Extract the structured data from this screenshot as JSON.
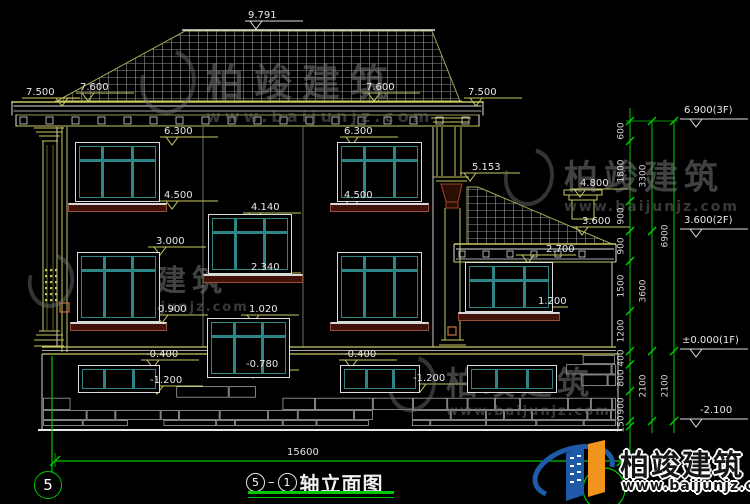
{
  "canvas": {
    "background": "#000000"
  },
  "colors": {
    "line_yellow": "#c8c860",
    "line_white": "#e0e0e0",
    "annotation_green": "#00c800",
    "window_teal": "#2e8585",
    "sill_brown": "#94503a",
    "logo_blue": "#1e5aa8",
    "logo_orange": "#f0941e"
  },
  "watermark": {
    "brand": "柏竣建筑",
    "site": "www.baijunjz.com"
  },
  "footer_logo": {
    "brand": "柏竣建筑",
    "site": "www.baijunjz.com"
  },
  "axis": {
    "left_bubble": "5",
    "bottom_width": "15600"
  },
  "title_block": {
    "axis_from": "5",
    "separator": "–",
    "axis_to": "1",
    "name": "轴立面图"
  },
  "levels": [
    {
      "label": "9.791",
      "tx": 248,
      "ty": 11,
      "x1": 245,
      "x2": 303,
      "y": 21,
      "tax": 256,
      "c": "w"
    },
    {
      "label": "7.600",
      "tx": 80,
      "ty": 83,
      "x1": 76,
      "x2": 134,
      "y": 93,
      "tax": 88,
      "c": "y"
    },
    {
      "label": "7.500",
      "tx": 26,
      "ty": 88,
      "x1": 22,
      "x2": 80,
      "y": 98,
      "tax": 62,
      "c": "y"
    },
    {
      "label": "7.600",
      "tx": 366,
      "ty": 83,
      "x1": 362,
      "x2": 420,
      "y": 93,
      "tax": 374,
      "c": "y"
    },
    {
      "label": "7.500",
      "tx": 468,
      "ty": 88,
      "x1": 464,
      "x2": 522,
      "y": 98,
      "tax": 476,
      "c": "y"
    },
    {
      "label": "6.300",
      "tx": 164,
      "ty": 127,
      "x1": 160,
      "x2": 218,
      "y": 137,
      "tax": 172,
      "c": "y"
    },
    {
      "label": "4.500",
      "tx": 164,
      "ty": 191,
      "x1": 160,
      "x2": 218,
      "y": 201,
      "tax": 172,
      "c": "y"
    },
    {
      "label": "6.300",
      "tx": 344,
      "ty": 127,
      "x1": 340,
      "x2": 398,
      "y": 137,
      "tax": 352,
      "c": "y"
    },
    {
      "label": "4.500",
      "tx": 344,
      "ty": 191,
      "x1": 340,
      "x2": 398,
      "y": 201,
      "tax": 352,
      "c": "y"
    },
    {
      "label": "5.153",
      "tx": 472,
      "ty": 163,
      "x1": 460,
      "x2": 520,
      "y": 173,
      "tax": 470,
      "c": "y"
    },
    {
      "label": "4.800",
      "tx": 580,
      "ty": 179,
      "x1": 570,
      "x2": 628,
      "y": 189,
      "tax": 580,
      "c": "y"
    },
    {
      "label": "3.600",
      "tx": 582,
      "ty": 217,
      "x1": 572,
      "x2": 630,
      "y": 227,
      "tax": 582,
      "c": "y"
    },
    {
      "label": "4.140",
      "tx": 251,
      "ty": 203,
      "x1": 243,
      "x2": 301,
      "y": 213,
      "tax": 255,
      "c": "y"
    },
    {
      "label": "2.340",
      "tx": 251,
      "ty": 263,
      "x1": 243,
      "x2": 301,
      "y": 273,
      "tax": 255,
      "c": "y"
    },
    {
      "label": "1.020",
      "tx": 249,
      "ty": 305,
      "x1": 241,
      "x2": 299,
      "y": 315,
      "tax": 253,
      "c": "y"
    },
    {
      "label": "-0.780",
      "tx": 246,
      "ty": 360,
      "x1": 241,
      "x2": 299,
      "y": 370,
      "tax": 253,
      "c": "y"
    },
    {
      "label": "3.000",
      "tx": 156,
      "ty": 237,
      "x1": 148,
      "x2": 206,
      "y": 247,
      "tax": 160,
      "c": "y"
    },
    {
      "label": "0.900",
      "tx": 158,
      "ty": 305,
      "x1": 150,
      "x2": 208,
      "y": 315,
      "tax": 162,
      "c": "y"
    },
    {
      "label": "2.700",
      "tx": 546,
      "ty": 245,
      "x1": 516,
      "x2": 576,
      "y": 255,
      "tax": 528,
      "c": "y"
    },
    {
      "label": "1.200",
      "tx": 538,
      "ty": 297,
      "x1": 508,
      "x2": 568,
      "y": 307,
      "tax": 520,
      "c": "y"
    },
    {
      "label": "-0.400",
      "tx": 146,
      "ty": 350,
      "x1": 141,
      "x2": 199,
      "y": 360,
      "tax": 153,
      "c": "y"
    },
    {
      "label": "-1.200",
      "tx": 150,
      "ty": 376,
      "x1": 145,
      "x2": 203,
      "y": 386,
      "tax": 157,
      "c": "y"
    },
    {
      "label": "-0.400",
      "tx": 344,
      "ty": 350,
      "x1": 339,
      "x2": 397,
      "y": 360,
      "tax": 351,
      "c": "y"
    },
    {
      "label": "-1.200",
      "tx": 413,
      "ty": 374,
      "x1": 408,
      "x2": 466,
      "y": 384,
      "tax": 420,
      "c": "y"
    },
    {
      "label": "6.900(3F)",
      "tx": 684,
      "ty": 106,
      "x1": 680,
      "x2": 748,
      "y": 119,
      "tax": 696,
      "c": "w"
    },
    {
      "label": "3.600(2F)",
      "tx": 684,
      "ty": 216,
      "x1": 680,
      "x2": 748,
      "y": 229,
      "tax": 696,
      "c": "w"
    },
    {
      "label": "±0.000(1F)",
      "tx": 682,
      "ty": 336,
      "x1": 680,
      "x2": 748,
      "y": 349,
      "tax": 696,
      "c": "w"
    },
    {
      "label": "-2.100",
      "tx": 700,
      "ty": 406,
      "x1": 680,
      "x2": 748,
      "y": 419,
      "tax": 696,
      "c": "w"
    }
  ],
  "dim_chains": {
    "columns": [
      {
        "x": 630,
        "top": 121,
        "segments": [
          "600",
          "1800",
          "900",
          "900",
          "1500",
          "1200",
          "400",
          "800",
          "900",
          "150"
        ]
      },
      {
        "x": 652,
        "top": 121,
        "segments": [
          "3300",
          "3600",
          "2100"
        ]
      },
      {
        "x": 674,
        "top": 121,
        "segments": [
          "6900",
          "2100"
        ]
      }
    ]
  }
}
